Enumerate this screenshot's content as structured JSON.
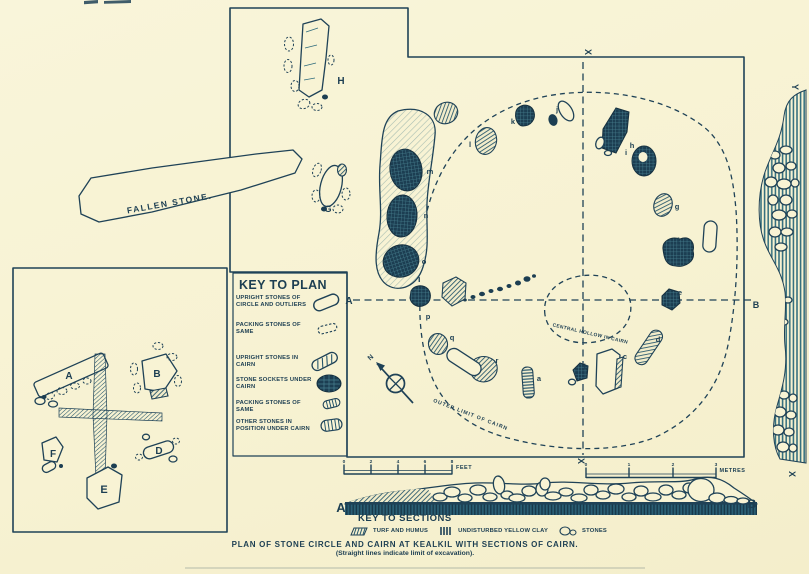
{
  "palette": {
    "paper": "#f8f3d4",
    "ink": "#1f4257",
    "ink_dark": "#16303f",
    "teal": "#2e6b7c"
  },
  "caption": {
    "line1": "PLAN OF STONE CIRCLE AND CAIRN AT KEALKIL WITH SECTIONS OF CAIRN.",
    "line2": "(Straight lines indicate limit of excavation)."
  },
  "key_to_plan": {
    "title": "KEY TO PLAN",
    "items": [
      {
        "label": "UPRIGHT STONES OF CIRCLE AND OUTLIERS"
      },
      {
        "label": "PACKING STONES OF SAME"
      },
      {
        "label": "UPRIGHT STONES IN CAIRN"
      },
      {
        "label": "STONE SOCKETS UNDER CAIRN"
      },
      {
        "label": "PACKING STONES OF SAME"
      },
      {
        "label": "OTHER STONES IN POSITION UNDER CAIRN"
      }
    ]
  },
  "key_to_sections": {
    "title": "KEY TO SECTIONS",
    "items": [
      {
        "label": "TURF AND HUMUS"
      },
      {
        "label": "UNDISTURBED YELLOW CLAY"
      },
      {
        "label": "STONES"
      }
    ]
  },
  "annotations": {
    "fallen_stone": "FALLEN STONE.",
    "central_hollow": "CENTRAL HOLLOW IN CAIRN",
    "outer_limit": "OUTER LIMIT OF CAIRN"
  },
  "scales": {
    "feet": {
      "label": "FEET",
      "ticks": [
        "0",
        "2",
        "4",
        "6",
        "8"
      ]
    },
    "metres": {
      "label": "METRES",
      "ticks": [
        "0",
        "1",
        "2",
        "3"
      ]
    }
  },
  "letters": {
    "outliers": {
      "h": "H",
      "g": "G"
    },
    "inset": {
      "a": "A",
      "b": "B",
      "d": "D",
      "e": "E",
      "f": "F"
    },
    "section_line": {
      "a": "A",
      "b": "B"
    },
    "section_profile": {
      "a": "A",
      "b": "B"
    },
    "axes": {
      "x_top": "X",
      "x_bottom": "X",
      "y_east": "Y",
      "x_east": "X"
    },
    "north": "N",
    "cairn_stones": {
      "a": "a",
      "b": "b",
      "c": "c",
      "d": "d",
      "e": "e",
      "f": "f",
      "g": "g",
      "h": "h",
      "i": "i",
      "j": "j",
      "k": "k",
      "l": "l",
      "m": "m",
      "n": "n",
      "o": "o",
      "p": "p",
      "q": "q",
      "r": "r"
    }
  }
}
